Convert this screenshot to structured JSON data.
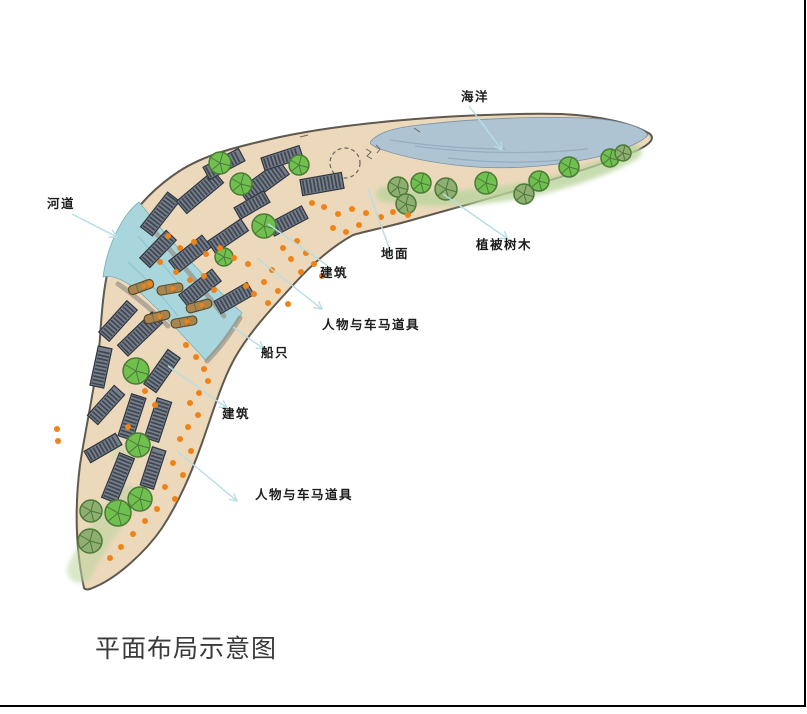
{
  "title": "平面布局示意图",
  "labels": {
    "ocean": "海洋",
    "river": "河道",
    "building_upper": "建筑",
    "ground": "地面",
    "vegetation": "植被树木",
    "figures_upper": "人物与车马道具",
    "boats": "船只",
    "building_lower": "建筑",
    "figures_lower": "人物与车马道具"
  },
  "colors": {
    "sand": "#ecd9bc",
    "outline": "#5f584e",
    "ocean": "#aec4d2",
    "ocean_streak": "#8aa4b8",
    "river": "#a9d6dc",
    "river_streak": "#7fbac3",
    "building": "#767e8a",
    "building_stripe": "#3f4652",
    "building_edge": "#2f353f",
    "tree_bright": "#6fc04f",
    "tree_olive": "#8fae72",
    "tree_dark": "#4c7a38",
    "boat": "#a8854e",
    "boat_edge": "#5c4726",
    "dot": "#ef8318",
    "leader": "#b7dde4",
    "quay": "#928d82",
    "green_strip": "#bad49c",
    "text": "#1c1c1c",
    "border": "#000000"
  },
  "scene": {
    "land_d": "M 84,588 C 78,560 73,520 80,465 C 86,425 97,378 100,338 C 102,305 105,268 117,242 C 130,213 151,190 178,172 C 205,154 240,146 280,137 C 318,129 352,125 392,121 C 445,116 510,113 562,114 C 602,116 634,124 650,134 C 655,139 650,144 638,150 C 612,161 578,172 538,184 C 498,196 452,209 412,220 C 388,227 366,231 353,235 C 333,246 312,264 295,283 C 271,309 249,333 236,356 C 223,378 214,409 202,443 C 191,474 179,502 162,528 C 145,553 117,577 97,586 C 91,589 86,591 84,588 Z",
    "ocean_d": "M 371,141 C 380,131 398,127 428,124 C 472,119 546,115 600,119 C 626,122 644,128 648,135 C 641,143 618,153 588,159 C 548,167 504,170 464,166 C 424,162 394,154 377,148 C 372,145 369,144 371,141 Z",
    "ocean_streaks": [
      "M 415,146 C 465,153 530,155 588,149",
      "M 448,158 C 498,164 542,163 578,158",
      "M 390,140 C 430,146 470,149 505,149"
    ],
    "river_d": "M 139,202 C 121,216 107,247 103,277 C 114,274 131,283 147,299 C 167,318 190,343 206,361 C 219,347 232,330 242,313 C 209,282 169,240 139,202 Z",
    "river_streaks": [
      "M 138,236 C 152,252 168,270 184,290",
      "M 128,262 C 145,277 162,296 178,316"
    ],
    "green_strokes": [
      {
        "d": "M 384,194 C 440,203 502,197 552,184 C 588,174 616,163 634,152",
        "w": 15,
        "op": 0.8
      },
      {
        "d": "M 80,570 C 95,540 110,520 128,498",
        "w": 26,
        "op": 0.55
      },
      {
        "d": "M 120,455 L 145,442",
        "w": 18,
        "op": 0.35
      }
    ],
    "quays": [
      "M 150,226 C 172,252 196,281 224,316",
      "M 118,284 C 134,295 152,310 168,326",
      "M 240,318 C 230,334 218,350 207,361"
    ],
    "marks": [
      "M 366,149 l 5,3 -4,4 5,3",
      "M 376,145 l 4,4 -3,4",
      "M 414,128 l 6,4",
      "M 300,137 l 8,-2"
    ],
    "dashed_circle": {
      "cx": 345,
      "cy": 163,
      "r": 15
    },
    "buildings": [
      [
        160,
        214,
        44,
        15,
        -52
      ],
      [
        200,
        192,
        48,
        16,
        -40
      ],
      [
        224,
        164,
        40,
        14,
        -28
      ],
      [
        264,
        182,
        50,
        17,
        -36
      ],
      [
        282,
        158,
        40,
        13,
        -18
      ],
      [
        322,
        184,
        42,
        16,
        -10
      ],
      [
        288,
        221,
        38,
        14,
        -28
      ],
      [
        252,
        205,
        34,
        13,
        -30
      ],
      [
        158,
        249,
        38,
        14,
        -46
      ],
      [
        190,
        254,
        42,
        15,
        -38
      ],
      [
        228,
        236,
        40,
        14,
        -34
      ],
      [
        200,
        288,
        42,
        15,
        -38
      ],
      [
        234,
        298,
        38,
        14,
        -30
      ],
      [
        118,
        321,
        42,
        14,
        -48
      ],
      [
        140,
        334,
        48,
        15,
        -44
      ],
      [
        101,
        367,
        40,
        14,
        -78
      ],
      [
        162,
        371,
        42,
        15,
        -55
      ],
      [
        106,
        405,
        40,
        14,
        -48
      ],
      [
        132,
        417,
        44,
        15,
        -72
      ],
      [
        158,
        420,
        42,
        15,
        -72
      ],
      [
        103,
        448,
        36,
        13,
        -30
      ],
      [
        118,
        478,
        48,
        16,
        -68
      ],
      [
        153,
        468,
        40,
        14,
        -72
      ]
    ],
    "trees": [
      [
        220,
        163,
        11,
        "b"
      ],
      [
        241,
        184,
        11,
        "b"
      ],
      [
        299,
        165,
        10,
        "b"
      ],
      [
        264,
        226,
        12,
        "b"
      ],
      [
        224,
        257,
        9,
        "b"
      ],
      [
        398,
        187,
        10,
        "o"
      ],
      [
        421,
        183,
        10,
        "b"
      ],
      [
        406,
        204,
        10,
        "o"
      ],
      [
        446,
        189,
        11,
        "o"
      ],
      [
        486,
        183,
        11,
        "b"
      ],
      [
        524,
        194,
        10,
        "o"
      ],
      [
        539,
        181,
        10,
        "b"
      ],
      [
        569,
        167,
        10,
        "b"
      ],
      [
        610,
        158,
        9,
        "b"
      ],
      [
        623,
        153,
        8,
        "o"
      ],
      [
        136,
        371,
        13,
        "b"
      ],
      [
        138,
        445,
        12,
        "b"
      ],
      [
        140,
        499,
        12,
        "b"
      ],
      [
        118,
        513,
        13,
        "b"
      ],
      [
        91,
        511,
        11,
        "o"
      ],
      [
        90,
        541,
        12,
        "o"
      ]
    ],
    "boats": [
      [
        141,
        287,
        -20
      ],
      [
        170,
        289,
        -10
      ],
      [
        199,
        306,
        -15
      ],
      [
        157,
        317,
        -14
      ],
      [
        184,
        322,
        -10
      ]
    ],
    "dots": [
      [
        312,
        203
      ],
      [
        324,
        207
      ],
      [
        338,
        214
      ],
      [
        352,
        209
      ],
      [
        366,
        213
      ],
      [
        381,
        217
      ],
      [
        393,
        212
      ],
      [
        408,
        215
      ],
      [
        333,
        228
      ],
      [
        346,
        232
      ],
      [
        359,
        225
      ],
      [
        297,
        241
      ],
      [
        306,
        253
      ],
      [
        314,
        264
      ],
      [
        322,
        276
      ],
      [
        301,
        272
      ],
      [
        291,
        259
      ],
      [
        283,
        248
      ],
      [
        272,
        270
      ],
      [
        264,
        282
      ],
      [
        254,
        294
      ],
      [
        278,
        291
      ],
      [
        268,
        303
      ],
      [
        288,
        304
      ],
      [
        168,
        236
      ],
      [
        180,
        248
      ],
      [
        194,
        242
      ],
      [
        206,
        254
      ],
      [
        220,
        248
      ],
      [
        234,
        258
      ],
      [
        248,
        264
      ],
      [
        176,
        272
      ],
      [
        190,
        280
      ],
      [
        160,
        262
      ],
      [
        150,
        284
      ],
      [
        204,
        276
      ],
      [
        214,
        290
      ],
      [
        246,
        286
      ],
      [
        186,
        345
      ],
      [
        196,
        357
      ],
      [
        204,
        369
      ],
      [
        208,
        381
      ],
      [
        199,
        393
      ],
      [
        190,
        403
      ],
      [
        198,
        415
      ],
      [
        188,
        427
      ],
      [
        180,
        439
      ],
      [
        191,
        451
      ],
      [
        173,
        463
      ],
      [
        183,
        475
      ],
      [
        165,
        487
      ],
      [
        175,
        499
      ],
      [
        157,
        509
      ],
      [
        145,
        521
      ],
      [
        133,
        534
      ],
      [
        121,
        547
      ],
      [
        110,
        558
      ],
      [
        145,
        391
      ],
      [
        155,
        405
      ],
      [
        128,
        427
      ],
      [
        57,
        429
      ],
      [
        58,
        441
      ]
    ],
    "leaders": [
      [
        469,
        106,
        502,
        150,
        1
      ],
      [
        72,
        214,
        117,
        237,
        1
      ],
      [
        268,
        224,
        328,
        266,
        0
      ],
      [
        368,
        189,
        391,
        253,
        0
      ],
      [
        443,
        194,
        508,
        239,
        1
      ],
      [
        257,
        258,
        322,
        309,
        1
      ],
      [
        233,
        327,
        264,
        349,
        1
      ],
      [
        168,
        366,
        227,
        408,
        1
      ],
      [
        177,
        451,
        237,
        501,
        1
      ]
    ]
  }
}
